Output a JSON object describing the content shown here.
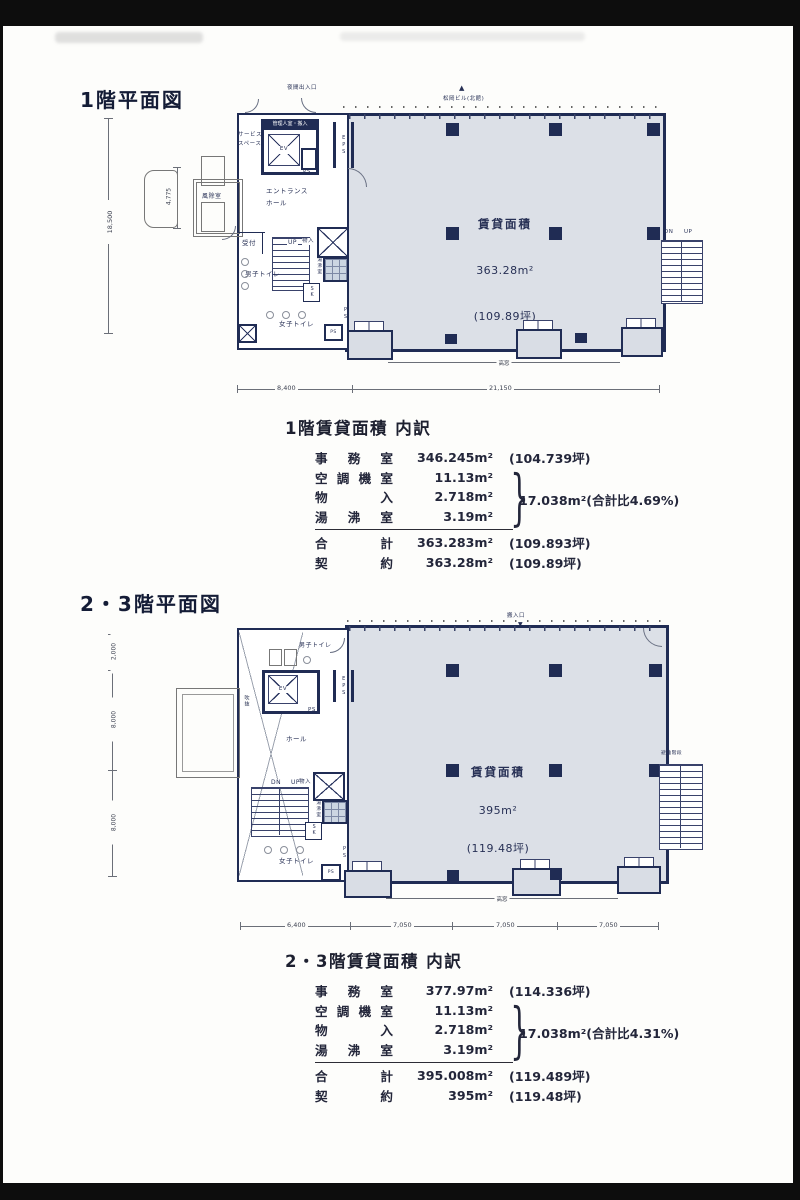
{
  "plan1": {
    "title": "1階平面図",
    "area": {
      "label": "賃貸面積",
      "m2": "363.28m²",
      "tsubo": "(109.89坪)"
    },
    "labels": {
      "night_exit": "夜間出入口",
      "north_marker": "▲",
      "north_bldg": "松岡ビル(北館)",
      "service_space": "サービス\nスペース",
      "admin_room": "管理人室・搬入",
      "ev": "EV",
      "ps_top": "PS",
      "eps": "EPS",
      "entrance_hall": "エントランス\nホール",
      "windbreak": "風除室",
      "reception": "受付",
      "up": "UP",
      "storage": "物入",
      "kitchenette": "湯沸室",
      "mens_toilet": "男子トイレ",
      "sk": "SK",
      "womens_toilet": "女子トイレ",
      "ps_bottom": "PS",
      "ps_shaft": "PS",
      "stair_dn": "DN",
      "stair_up": "UP",
      "highwindow": "高窓"
    },
    "dims": {
      "height": "18,500",
      "porch": "4,775",
      "bottom_left": "8,400",
      "bottom_right": "21,150"
    }
  },
  "table1": {
    "title": "1階賃貸面積 内訳",
    "rows": [
      {
        "label": "事務室",
        "value": "346.245m²",
        "note": "(104.739坪)"
      },
      {
        "label": "空調機室",
        "value": "11.13m²",
        "note": ""
      },
      {
        "label": "物入",
        "value": "2.718m²",
        "note": ""
      },
      {
        "label": "湯沸室",
        "value": "3.19m²",
        "note": ""
      }
    ],
    "brace": "}",
    "brace_note": "17.038m²(合計比4.69%)",
    "total": {
      "label": "合計",
      "value": "363.283m²",
      "note": "(109.893坪)"
    },
    "contract": {
      "label": "契約",
      "value": "363.28m²",
      "note": "(109.89坪)"
    }
  },
  "plan2": {
    "title": "2・3階平面図",
    "area": {
      "label": "賃貸面積",
      "m2": "395m²",
      "tsubo": "(119.48坪)"
    },
    "labels": {
      "carry_in": "搬入口",
      "carry_marker": "▼",
      "mens_toilet": "男子トイレ",
      "ev": "EV",
      "eps": "EPS",
      "ps_top": "PS",
      "atrium": "吹抜",
      "hall": "ホール",
      "stair_dn": "DN",
      "stair_up": "UP",
      "storage": "物入",
      "kitchenette": "湯沸室",
      "sk": "SK",
      "womens_toilet": "女子トイレ",
      "ps_bottom": "PS",
      "ps_shaft": "PS",
      "escape_stair": "避難階段",
      "esc_dn": "DN",
      "esc_up": "UP",
      "highwindow": "高窓"
    },
    "dims": {
      "left_top": "2,000",
      "left_mid": "8,000",
      "left_bottom": "8,000",
      "b1": "6,400",
      "b2": "7,050",
      "b3": "7,050",
      "b4": "7,050"
    }
  },
  "table2": {
    "title": "2・3階賃貸面積 内訳",
    "rows": [
      {
        "label": "事務室",
        "value": "377.97m²",
        "note": "(114.336坪)"
      },
      {
        "label": "空調機室",
        "value": "11.13m²",
        "note": ""
      },
      {
        "label": "物入",
        "value": "2.718m²",
        "note": ""
      },
      {
        "label": "湯沸室",
        "value": "3.19m²",
        "note": ""
      }
    ],
    "brace": "}",
    "brace_note": "17.038m²(合計比4.31%)",
    "total": {
      "label": "合計",
      "value": "395.008m²",
      "note": "(119.489坪)"
    },
    "contract": {
      "label": "契約",
      "value": "395m²",
      "note": "(119.48坪)"
    }
  }
}
